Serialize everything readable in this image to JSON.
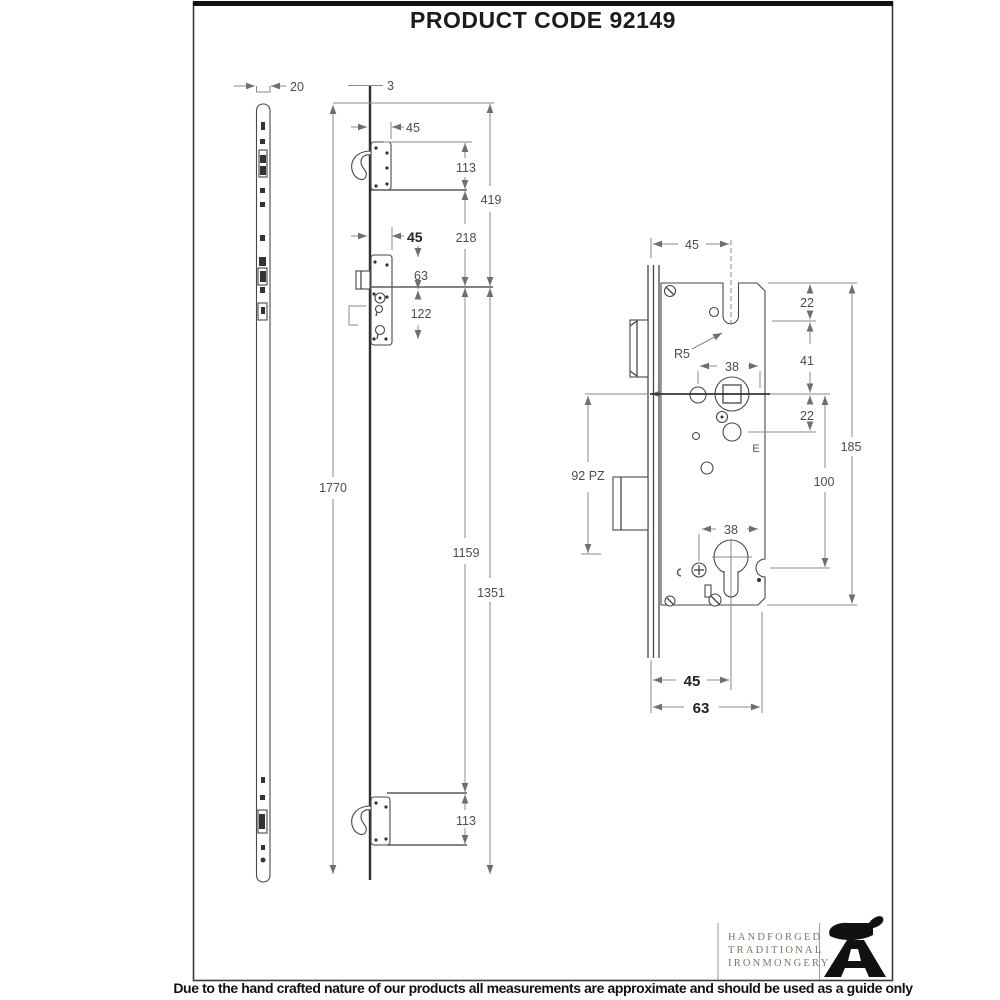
{
  "title": "PRODUCT CODE 92149",
  "keep_view": {
    "width": "20"
  },
  "strip_view": {
    "thickness": "3",
    "hook_top_backset": "45",
    "hook_top_height": "113",
    "top_to_center": "419",
    "center_backset": "45",
    "hook_top_to_center": "218",
    "case_top_offset": "63",
    "case_bottom_offset": "122",
    "total_length": "1770",
    "center_to_hook_bottom": "1159",
    "center_to_end": "1351",
    "hook_bottom_height": "113"
  },
  "case_view": {
    "backset": "45",
    "notch_radius": "R5",
    "top_to_hole": "22",
    "hole_to_follower": "41",
    "follower_hole_spacing": "38",
    "follower_to_hole": "22",
    "case_height": "185",
    "follower_to_cylinder": "100",
    "pz_size": "92 PZ",
    "cylinder_hole_spacing": "38",
    "backset_bottom": "45",
    "case_depth": "63",
    "stamp": "E"
  },
  "logo": {
    "line1": "HANDFORGED",
    "line2": "TRADITIONAL",
    "line3": "IRONMONGERY"
  },
  "footer": {
    "disclaimer": "Due to the hand crafted nature of our products all measurements are approximate and should be used as a guide only"
  },
  "colors": {
    "line": "#474747",
    "dimension": "#8a8a8a",
    "label": "#4c4c4c",
    "logo_text": "#85746a",
    "anvil": "#111111",
    "frame": "#333333"
  }
}
